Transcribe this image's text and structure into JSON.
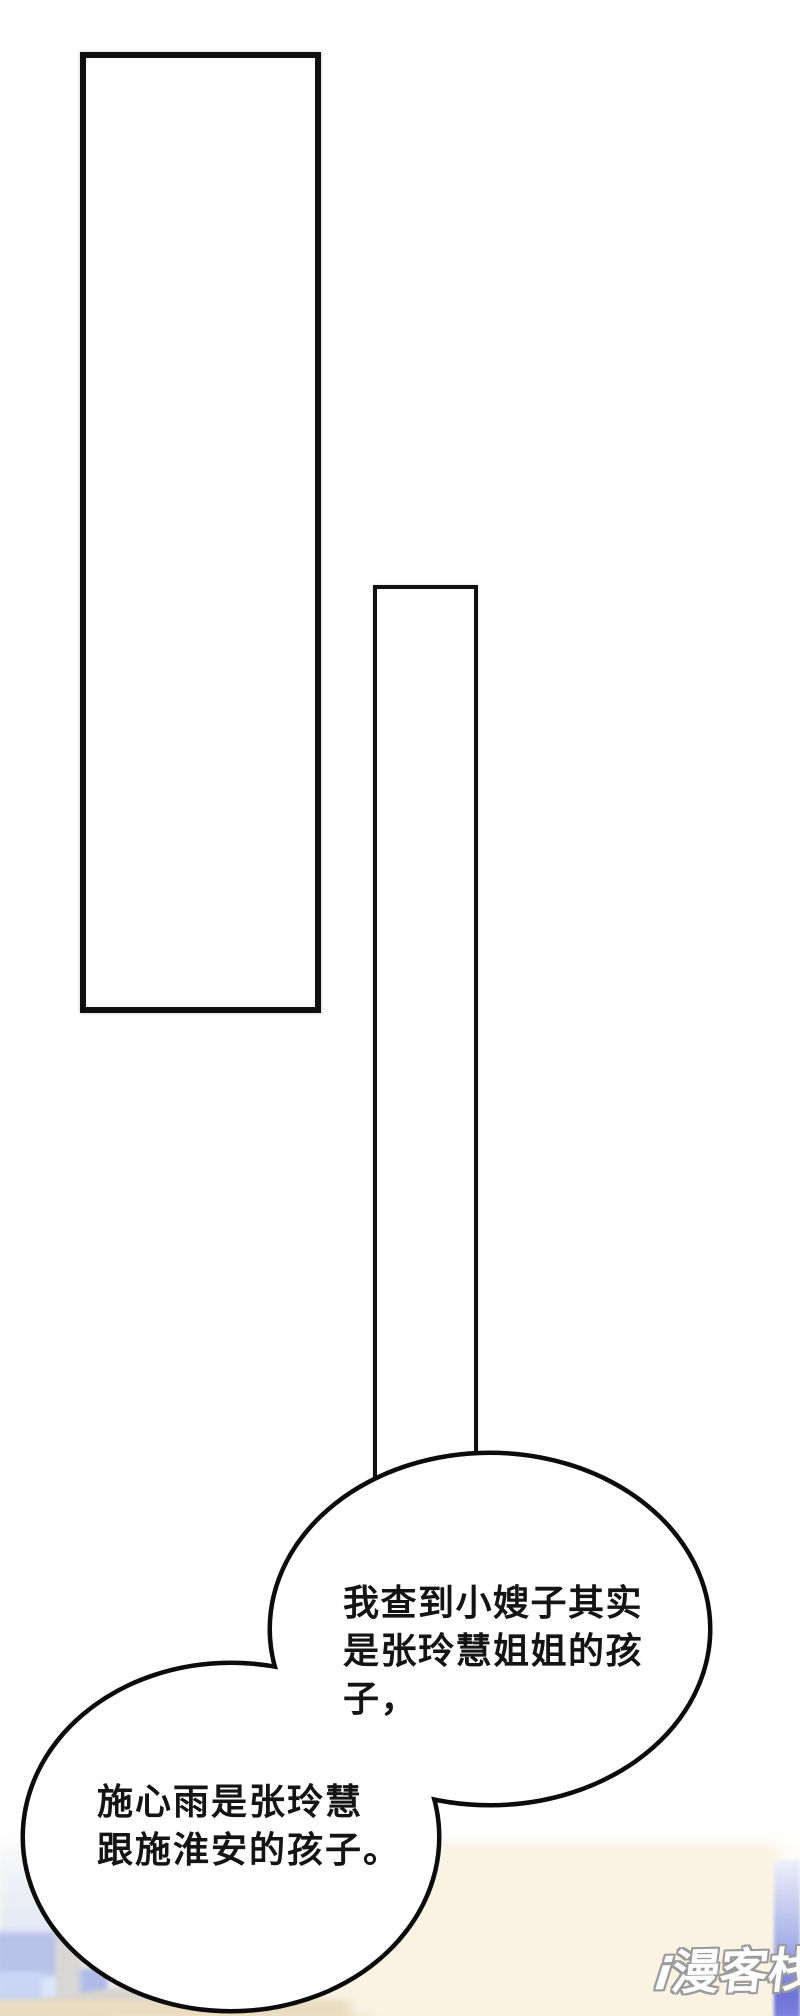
{
  "page": {
    "width": 800,
    "height": 2016,
    "background": "#ffffff"
  },
  "panels": {
    "border_color": "#101010"
  },
  "speech_bubble": {
    "fill": "#ffffff",
    "outline": "#0c0c0c",
    "text_color": "#141414",
    "upper_lines": [
      "我查到小嫂子其实",
      "是张玲慧姐姐的孩",
      "子，"
    ],
    "lower_lines": [
      "施心雨是张玲慧",
      "跟施淮安的孩子。"
    ]
  },
  "watermark": {
    "i_mark": "i",
    "text": "漫客栈",
    "fill": "#fdfdfd",
    "outline": "#9b9b9b"
  },
  "photo_strip_colors": {
    "sky_blue": "#b9c3ea",
    "cloud_blue": "#c9d5f3",
    "window_frame_gray": "#d9d7d6",
    "cream": "#faf2e2",
    "beige": "#e9dcc0",
    "right_band_blue": "#6f74d8"
  }
}
